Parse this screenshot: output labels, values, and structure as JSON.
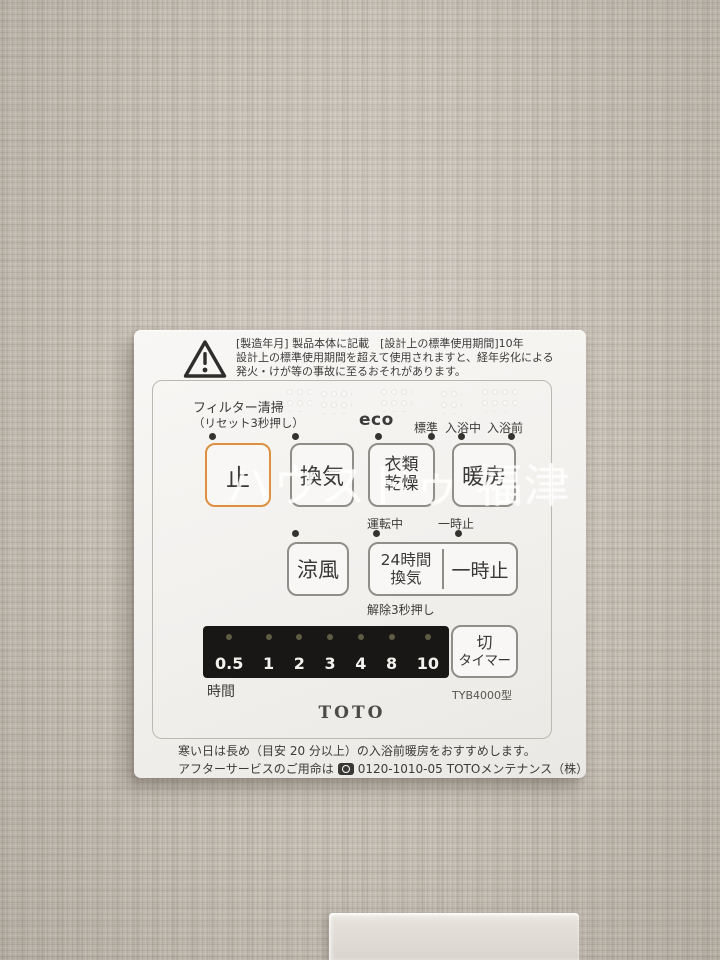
{
  "watermark": "ハウスドゥ 福津",
  "warning": {
    "line1": "[製造年月] 製品本体に記載　[設計上の標準使用期間]10年",
    "line2": "設計上の標準使用期間を超えて使用されますと、経年劣化による",
    "line3": "発火・けが等の事故に至るおそれがあります。"
  },
  "labels": {
    "filter_clean": "フィルター清掃",
    "filter_reset": "（リセット3秒押し）",
    "eco": "eco",
    "standard": "標準",
    "bathing": "入浴中",
    "pre_bath": "入浴前",
    "running": "運転中",
    "pause_indicator": "一時止",
    "cancel_hint": "解除3秒押し",
    "hours": "時間",
    "model": "TYB4000型",
    "brand": "TOTO"
  },
  "buttons": {
    "stop": "止",
    "ventilation": "換気",
    "clothes_dry_line1": "衣類",
    "clothes_dry_line2": "乾燥",
    "heating": "暖房",
    "cool_breeze": "涼風",
    "vent24_line1": "24時間",
    "vent24_line2": "換気",
    "pause": "一時止",
    "off_timer_line1": "切",
    "off_timer_line2": "タイマー"
  },
  "timer": {
    "values": [
      "0.5",
      "1",
      "2",
      "3",
      "4",
      "8",
      "10"
    ]
  },
  "footer": {
    "line1": "寒い日は長め（目安 20 分以上）の入浴前暖房をおすすめします。",
    "line2_prefix": "アフターサービスのご用命は",
    "phone": "0120-1010-05",
    "line2_suffix": "TOTOメンテナンス（株）"
  },
  "colors": {
    "stop_button_border": "#DD9140",
    "panel_background": "#F2F0ED",
    "display_background": "#181715",
    "led_dim": "#5F5C45",
    "text": "#3C3B39",
    "watermark": "#FFFFFF",
    "wallpaper": "#C7C0B5"
  }
}
